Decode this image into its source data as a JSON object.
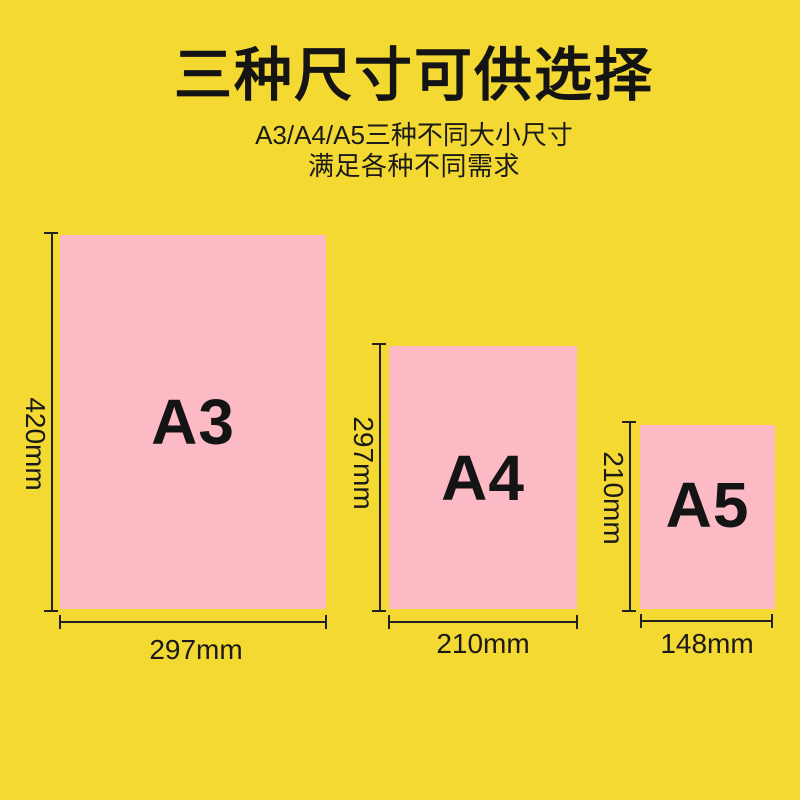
{
  "colors": {
    "background": "#F4D932",
    "paper": "#FCBAC5",
    "text": "#141414",
    "dimension_line": "#222222"
  },
  "header": {
    "title": "三种尺寸可供选择",
    "subtitle_line1": "A3/A4/A5三种不同大小尺寸",
    "subtitle_line2": "满足各种不同需求"
  },
  "papers": [
    {
      "label": "A3",
      "height_label": "420mm",
      "width_label": "297mm"
    },
    {
      "label": "A4",
      "height_label": "297mm",
      "width_label": "210mm"
    },
    {
      "label": "A5",
      "height_label": "210mm",
      "width_label": "148mm"
    }
  ]
}
